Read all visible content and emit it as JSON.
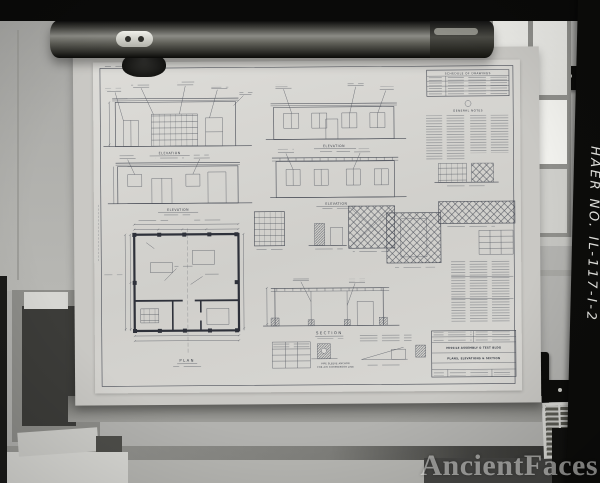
{
  "photo": {
    "film_label": "HAER NO. IL-117-I-2",
    "watermark": "AncientFaces"
  },
  "sheet": {
    "schedule": {
      "title": "SCHEDULE OF DRAWINGS"
    },
    "notes_title": "GENERAL NOTES",
    "captions": {
      "elev_a": "ELEVATION",
      "elev_b": "ELEVATION",
      "elev_c": "ELEVATION",
      "elev_d": "ELEVATION",
      "plan": "PLAN",
      "section": "SECTION",
      "pipe_line1": "PIPE SLEEVE ANCHOR",
      "pipe_line2": "FOR AIR COMPRESSOR LINE"
    },
    "title_block": {
      "project": "MISSILE ASSEMBLY & TEST BLDG",
      "sheet_title": "PLANS, ELEVATIONS & SECTION"
    }
  }
}
